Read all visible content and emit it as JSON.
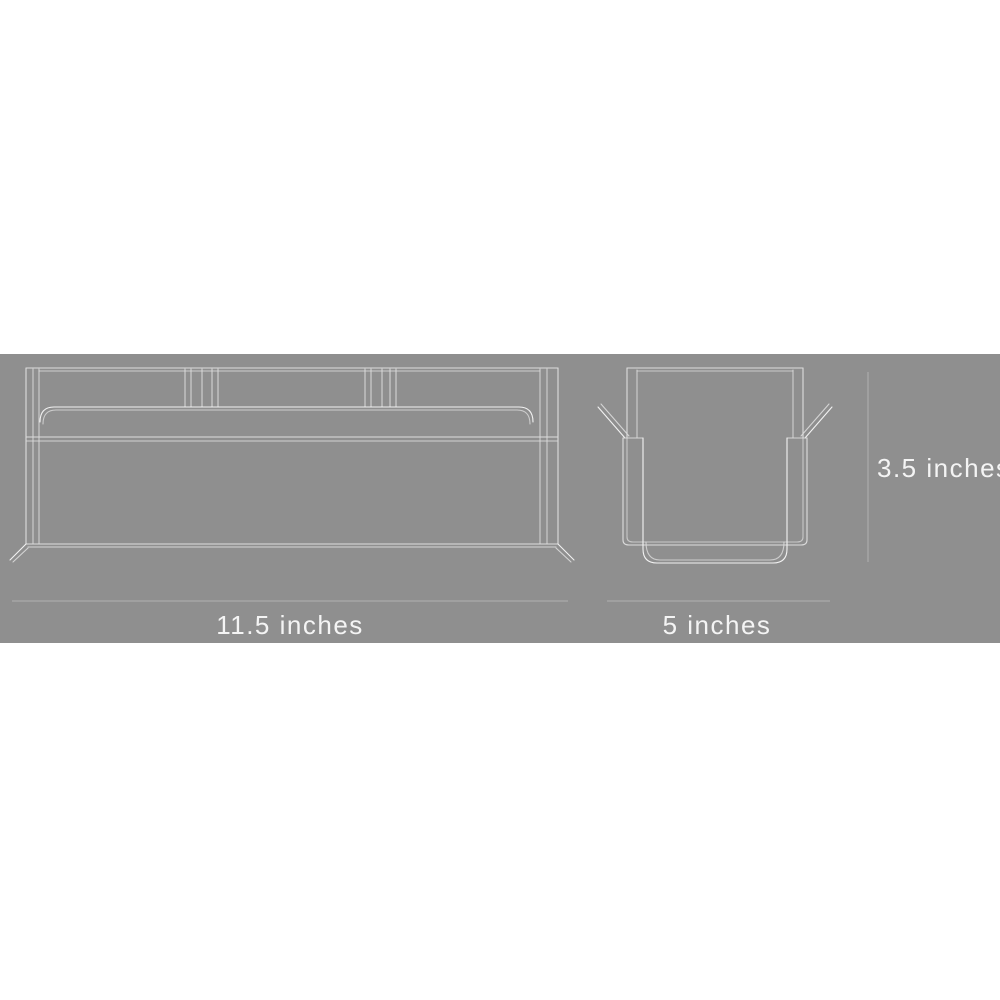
{
  "colors": {
    "page_bg": "#ffffff",
    "panel_bg": "#8f8f8f",
    "line": "#dcdcdc",
    "line_bright": "#f2f2f2",
    "dimension_line": "#b2b2b2",
    "text": "#f4f4f4"
  },
  "diagram": {
    "title": "product-dimensions-diagram",
    "views": [
      {
        "name": "front-view",
        "dimension_label": "11.5 inches"
      },
      {
        "name": "side-view",
        "dimension_label": "5 inches"
      }
    ],
    "dimensions": {
      "width": "11.5 inches",
      "depth": "5 inches",
      "height": "3.5 inches"
    }
  }
}
